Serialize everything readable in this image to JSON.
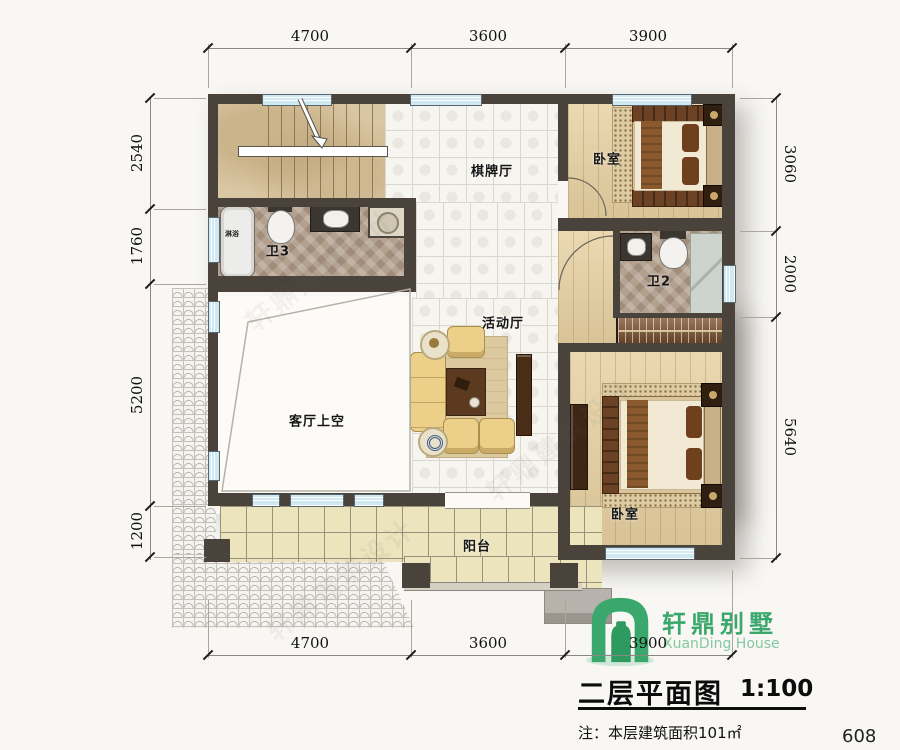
{
  "watermark": "轩鼎建筑设计",
  "rooms": {
    "chess_hall": "棋牌厅",
    "bedroom_top": "卧室",
    "bath3": "卫3",
    "bath2": "卫2",
    "activity_hall": "活动厅",
    "living_void": "客厅上空",
    "bedroom_bottom": "卧室",
    "balcony": "阳台",
    "shower": "淋浴"
  },
  "dimensions": {
    "top": [
      "4700",
      "3600",
      "3900"
    ],
    "bottom": [
      "4700",
      "3600",
      "3900"
    ],
    "left": [
      "2540",
      "1760",
      "5200",
      "1200"
    ],
    "right": [
      "3060",
      "2000",
      "5640"
    ]
  },
  "titleblock": {
    "brand_cn": "轩鼎别墅",
    "brand_en": "XuanDing House",
    "title": "二层平面图",
    "scale": "1:100",
    "note": "注：本层建筑面积101㎡",
    "page": "608"
  },
  "colors": {
    "brand_green": "#3aa86c",
    "brand_green_light": "#85c8a2",
    "wall": "#4a433c",
    "window_blue": "#cfe9f2"
  }
}
